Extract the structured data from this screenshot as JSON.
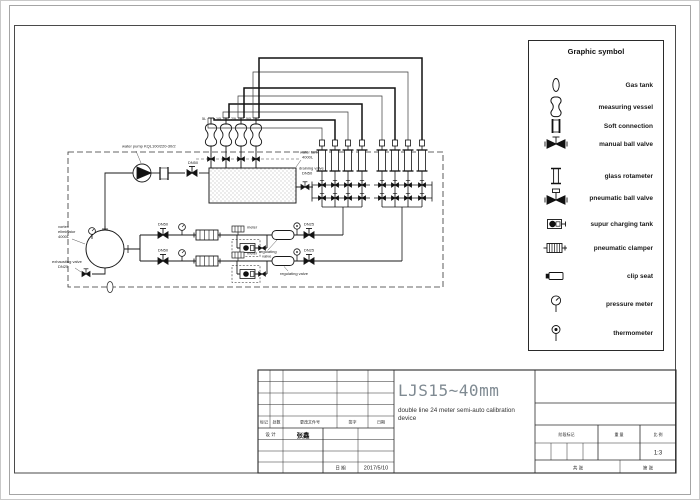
{
  "legend": {
    "title": "Graphic symbol",
    "items": [
      {
        "icon": "gas-tank-icon",
        "label": "Gas tank"
      },
      {
        "icon": "measuring-vessel-icon",
        "label": "measuring vessel"
      },
      {
        "icon": "soft-connection-icon",
        "label": "Soft connection"
      },
      {
        "icon": "manual-ball-valve-icon",
        "label": "manual ball valve"
      },
      {
        "icon": "glass-rotameter-icon",
        "label": "glass rotameter"
      },
      {
        "icon": "pneumatic-ball-valve-icon",
        "label": "pneumatic ball valve"
      },
      {
        "icon": "supur-charging-tank-icon",
        "label": "supur charging tank"
      },
      {
        "icon": "pneumatic-clamper-icon",
        "label": "pneumatic clamper"
      },
      {
        "icon": "clip-seat-icon",
        "label": "clip seat"
      },
      {
        "icon": "pressure-meter-icon",
        "label": "pressure meter"
      },
      {
        "icon": "thermometer-icon",
        "label": "thermometer"
      }
    ]
  },
  "diagram": {
    "water_pump_label": "water pump  KQL100/220-30/2",
    "pump_valve_dn": "DN50",
    "water_tank_label": "water tank",
    "water_tank_volume": "4000L",
    "draining_valve_label": "draining valve",
    "draining_valve_dn": "DN50",
    "vessel_labels": [
      "5L",
      "10L",
      "25L",
      "50L"
    ],
    "vortex_line1": "vortex",
    "vortex_line2": "eliminator",
    "vortex_volume": "4000L",
    "exhaust_line1": "exhausting valve",
    "exhaust_line2": "DN25",
    "branch_valve_dn": "DN50",
    "reg_valve_dn": "DN25",
    "meter_label": "meter",
    "regulating_label_a": "regulating",
    "regulating_label_b": "valve",
    "regulating_label_full": "regulating valve"
  },
  "title_block": {
    "main_title": "LJS15~40mm",
    "subtitle_1": "double line  24 meter semi-auto calibration",
    "subtitle_2": "device",
    "rev_headers": [
      "标记",
      "处数",
      "更改文件号",
      "签字",
      "日期"
    ],
    "design_label": "设 计",
    "design_name": "张鑫",
    "date_label": "日 期",
    "date_value": "2017/5/10",
    "stage_label": "阶段标记",
    "weight_label": "重 量",
    "scale_label": "比 例",
    "scale_value": "1:3",
    "sheet_total": "共  张",
    "sheet_no": "第  张"
  }
}
